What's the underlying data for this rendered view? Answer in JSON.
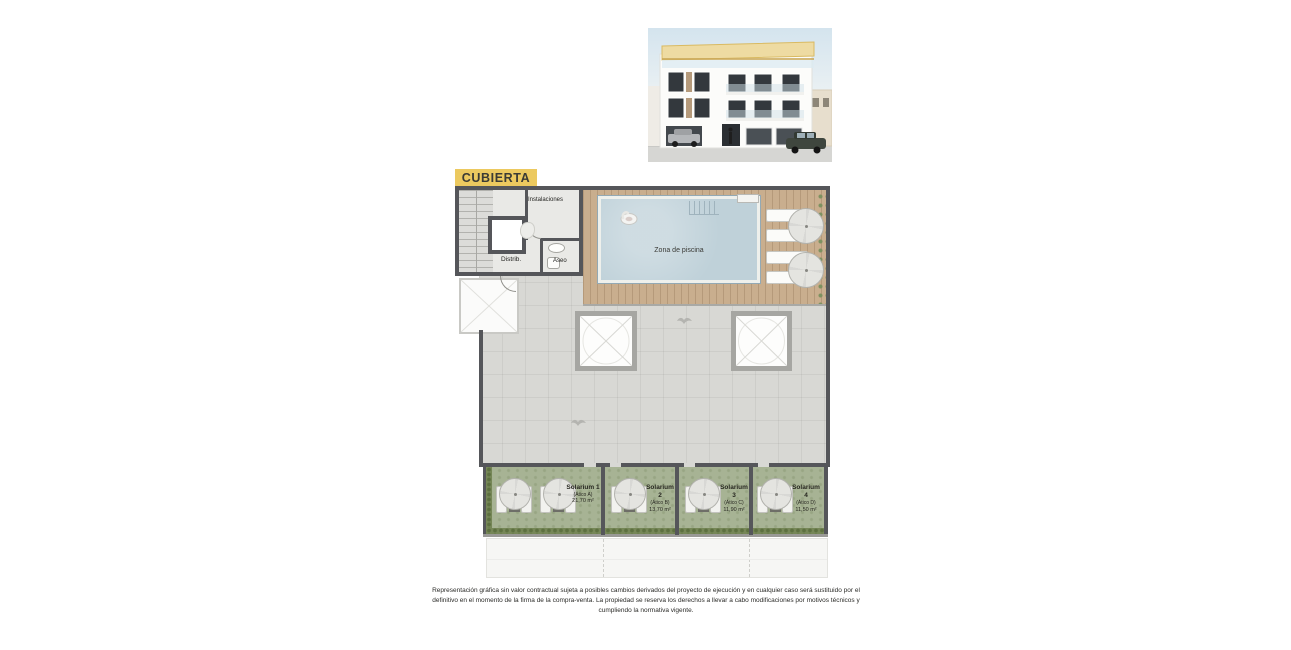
{
  "plan": {
    "level_label": "CUBIERTA",
    "rooms": {
      "instalaciones": "Instalaciones",
      "distrib": "Distrib.",
      "aseo": "Aseo",
      "zona_piscina": "Zona de piscina"
    },
    "solariums": [
      {
        "name": "Solarium 1",
        "unit": "(Ático A)",
        "area": "21,70 m²"
      },
      {
        "name": "Solarium 2",
        "unit": "(Ático B)",
        "area": "13,70 m²"
      },
      {
        "name": "Solarium 3",
        "unit": "(Ático C)",
        "area": "11,90 m²"
      },
      {
        "name": "Solarium 4",
        "unit": "(Ático D)",
        "area": "11,50 m²"
      }
    ]
  },
  "colors": {
    "label_bg": "#ecc95f",
    "wall": "#55565a",
    "wood_deck": "#c9ae8e",
    "pool_water": "#bfd1d9",
    "terrace": "#d8d8d4",
    "solarium_turf": "#a7b394",
    "plants": "#768757",
    "pergola_yellow": "#eedba2"
  },
  "disclaimer": "Representación gráfica sin valor contractual sujeta a posibles cambios derivados del proyecto de ejecución y en cualquier caso será sustituido por el definitivo en el momento de la firma de la compra-venta. La propiedad se reserva los derechos a llevar a cabo modificaciones por motivos técnicos y cumpliendo la normativa vigente."
}
